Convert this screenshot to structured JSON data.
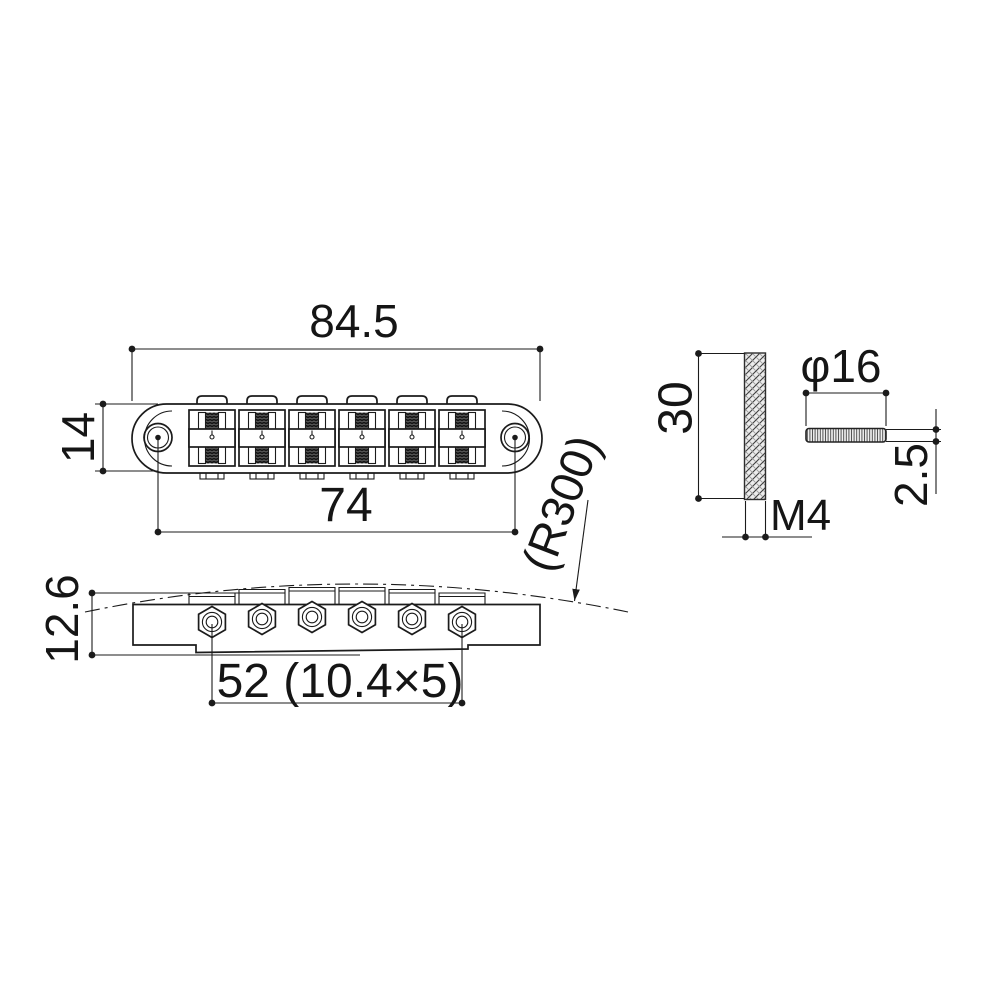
{
  "drawing": {
    "type": "technical-drawing-guitar-bridge",
    "colors": {
      "background": "#ffffff",
      "line": "#1b1b1b"
    },
    "labels": {
      "overall_width": "84.5",
      "body_depth": "14",
      "post_spacing": "74",
      "radius_note": "(R300)",
      "side_height": "12.6",
      "string_spacing": "52 (10.4×5)",
      "stud_length": "30",
      "thread_size": "M4",
      "wheel_diameter": "φ16",
      "wheel_thickness": "2.5"
    }
  }
}
